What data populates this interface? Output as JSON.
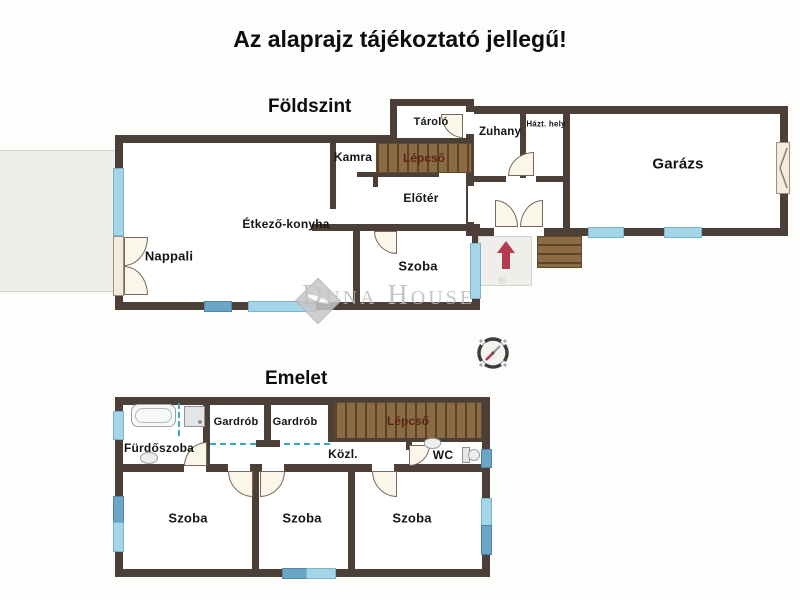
{
  "title": "Az alaprajz tájékoztató jellegű!",
  "watermark": {
    "brand": "Duna House",
    "reg": "®"
  },
  "ground": {
    "label": "Földszint",
    "rooms": {
      "nappali": "Nappali",
      "etkezo_konyha": "Étkező-konyha",
      "kamra": "Kamra",
      "lepcso": "Lépcső",
      "eloter": "Előtér",
      "szoba": "Szoba",
      "tarolo": "Tároló",
      "zuhany": "Zuhany",
      "hazt_hely": "Házt. hely",
      "garazs": "Garázs"
    }
  },
  "upper": {
    "label": "Emelet",
    "rooms": {
      "furdoszoba": "Fürdőszoba",
      "gardrob_1": "Gardrób",
      "gardrob_2": "Gardrób",
      "lepcso": "Lépcső",
      "kozl": "Közl.",
      "wc": "WC",
      "szoba_1": "Szoba",
      "szoba_2": "Szoba",
      "szoba_3": "Szoba"
    }
  },
  "colors": {
    "wall": "#4b3f37",
    "window_light": "#a5d6e8",
    "window_mid": "#6aa7c6",
    "stairs_fill": "#8a6b44",
    "stairs_label": "#5f2315",
    "entry_arrow": "#b23b52",
    "terrace": "#efeeeb",
    "door_leaf": "#f2ecdc",
    "watermark_gray": "#bcbcbc"
  }
}
